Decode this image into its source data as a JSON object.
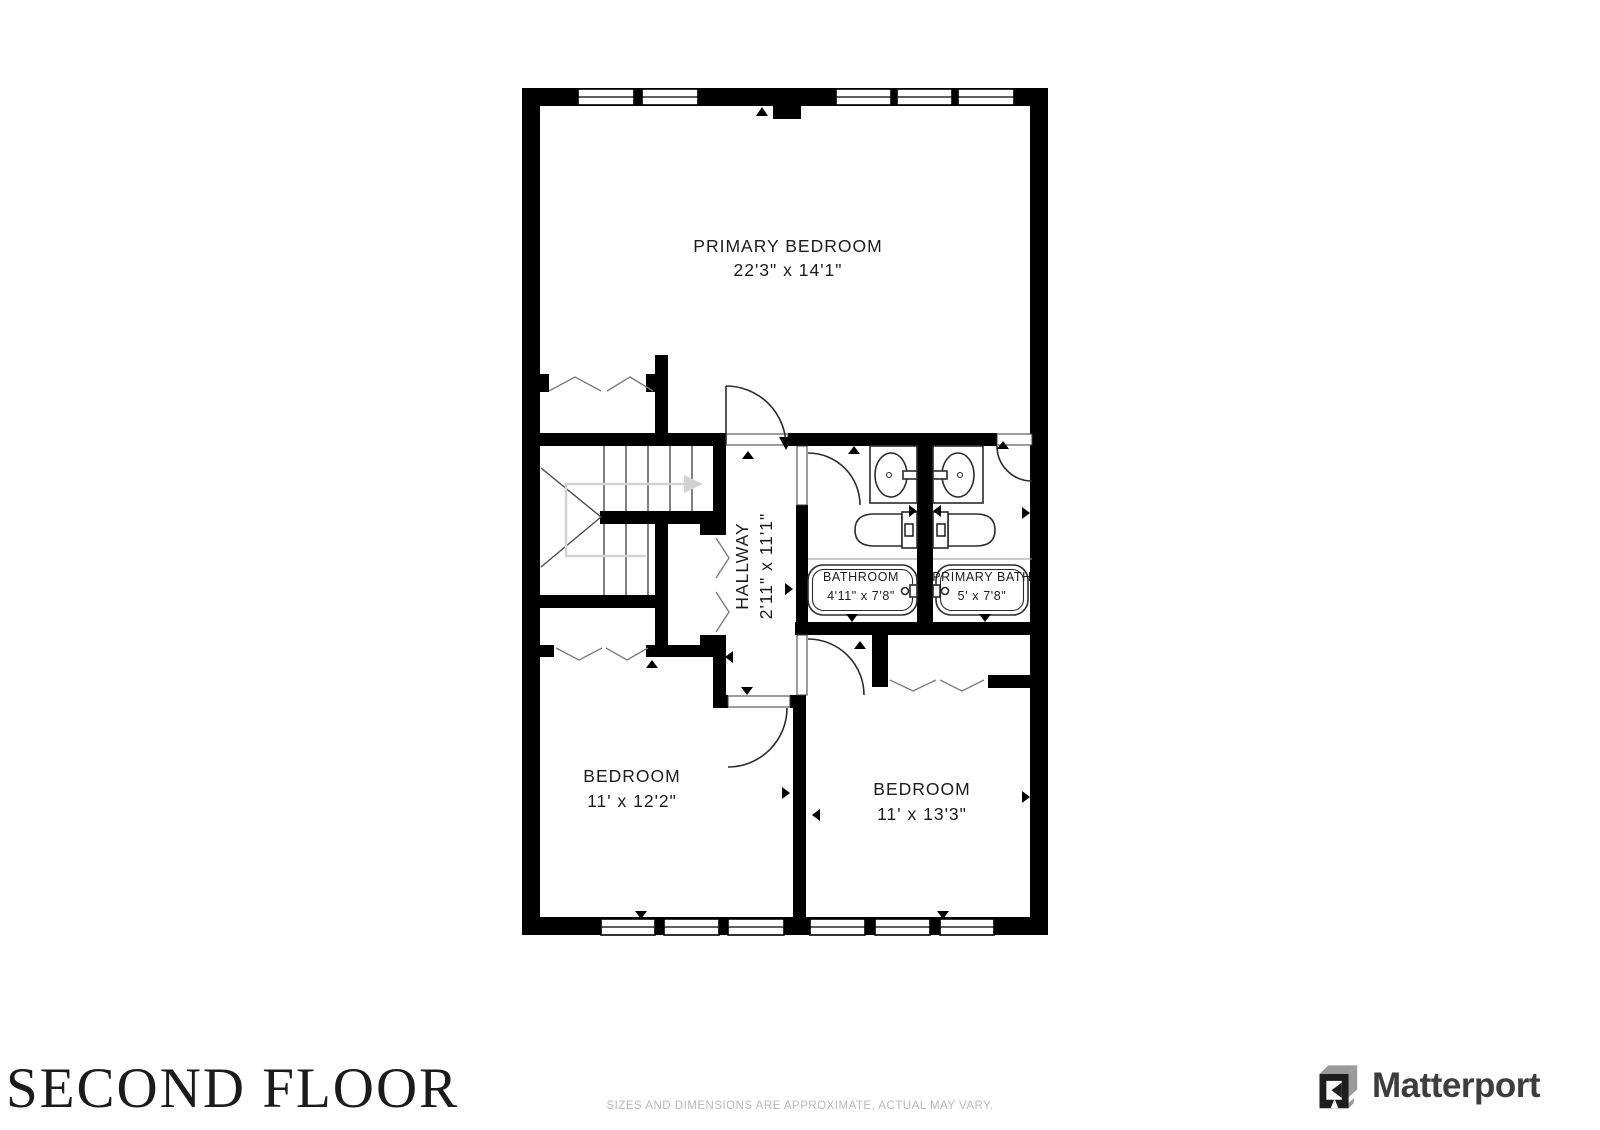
{
  "floor": {
    "title": "SECOND FLOOR"
  },
  "disclaimer": "SIZES AND DIMENSIONS ARE APPROXIMATE, ACTUAL MAY VARY.",
  "brand": {
    "name": "Matterport",
    "icon": "matterport-cube-m-icon"
  },
  "plan": {
    "rooms": [
      {
        "id": "primary-bedroom",
        "label": "PRIMARY BEDROOM",
        "dims": "22'3\" x 14'1\""
      },
      {
        "id": "hallway",
        "label": "HALLWAY",
        "dims": "2'11\" x 11'1\""
      },
      {
        "id": "bathroom",
        "label": "BATHROOM",
        "dims": "4'11\" x 7'8\""
      },
      {
        "id": "primary-bath",
        "label": "PRIMARY BATH",
        "dims": "5' x 7'8\""
      },
      {
        "id": "bedroom-left",
        "label": "BEDROOM",
        "dims": "11' x 12'2\""
      },
      {
        "id": "bedroom-right",
        "label": "BEDROOM",
        "dims": "11' x 13'3\""
      }
    ],
    "fixtures": [
      "stairs",
      "bathtub",
      "toilet",
      "sink",
      "door-swing",
      "bifold-closet-doors",
      "windows"
    ],
    "colors": {
      "wall": "#000000",
      "background": "#ffffff",
      "fixture_line": "#2b2b2b",
      "stair_arrow": "#d2d2d2",
      "marker": "#000000",
      "disclaimer_text": "#b9b9bd",
      "title_text": "#1b1b1b",
      "brand_text": "#3d3d3d",
      "brand_icon_dark": "#1e1e1e",
      "brand_icon_gray": "#9a9a9a"
    }
  }
}
